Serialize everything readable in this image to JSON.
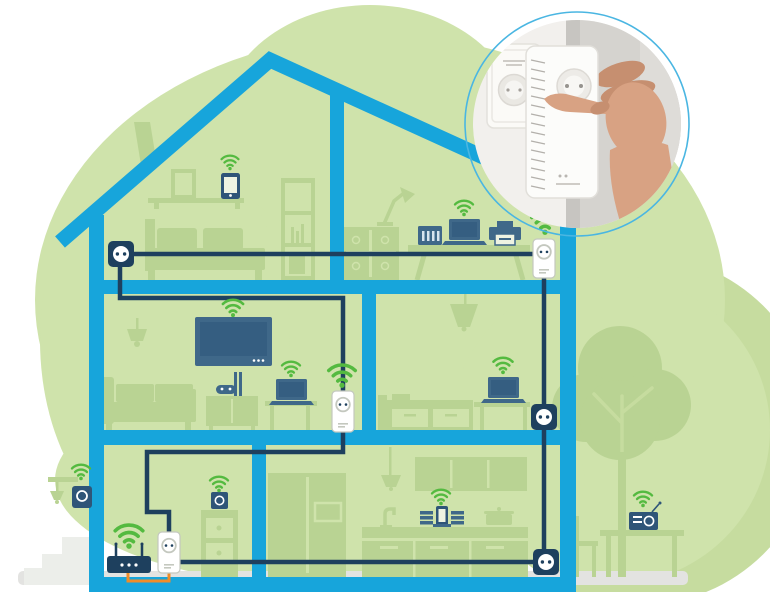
{
  "scene": {
    "description": "Cross-section illustration of a two-storey house with a powerline and WiFi home network; circular photo inset of a hand plugging a powerline adapter into a wall outlet",
    "inset_caption": "hand plugging white powerline adapter into wall socket",
    "colors": {
      "background": "#ffffff",
      "blob": "#cfe3ab",
      "blob2": "#c6dc9f",
      "silhouette": "#b9d393",
      "house": "#17a5db",
      "cable": "#1e405e",
      "device": "#3f6889",
      "device_dark": "#2f5578",
      "device_screen": "#355e81",
      "wifi": "#54ba40",
      "orange": "#f08c28",
      "ground": "#e3e3e1",
      "steps": "#eceeea",
      "ring": "#4ab6e2",
      "skin": "#d8a283",
      "skin_dark": "#c68f70",
      "photo_wall": "#f2f0ed",
      "photo_grey": "#d5d3cf",
      "photo_corner": "#c7c5c1",
      "adapter_line": "#c4c8bf"
    },
    "wifi_icons": [
      {
        "id": "wifi-attic-phone",
        "x": 230,
        "y": 155,
        "s": 0.8
      },
      {
        "id": "wifi-office-laptop",
        "x": 464,
        "y": 200,
        "s": 0.85
      },
      {
        "id": "wifi-office-adapter",
        "x": 545,
        "y": 211,
        "s": 1.25
      },
      {
        "id": "wifi-living-tv",
        "x": 233,
        "y": 299,
        "s": 0.95
      },
      {
        "id": "wifi-living-laptop",
        "x": 291,
        "y": 361,
        "s": 0.85
      },
      {
        "id": "wifi-living-adapter",
        "x": 342,
        "y": 364,
        "s": 1.25
      },
      {
        "id": "wifi-sitting-laptop",
        "x": 503,
        "y": 357,
        "s": 0.9
      },
      {
        "id": "wifi-router",
        "x": 129,
        "y": 524,
        "s": 1.3
      },
      {
        "id": "wifi-cellar-speaker",
        "x": 219,
        "y": 476,
        "s": 0.85
      },
      {
        "id": "wifi-kitchen-dock",
        "x": 441,
        "y": 489,
        "s": 0.85
      },
      {
        "id": "wifi-outdoor-speaker",
        "x": 81,
        "y": 464,
        "s": 0.85
      },
      {
        "id": "wifi-garden-radio",
        "x": 643,
        "y": 491,
        "s": 0.85
      }
    ],
    "outlets": [
      {
        "id": "outlet-attic",
        "x": 121,
        "y": 254
      },
      {
        "id": "outlet-sitting-room",
        "x": 544,
        "y": 417
      },
      {
        "id": "outlet-kitchen",
        "x": 546,
        "y": 562
      }
    ],
    "adapters": [
      {
        "id": "adapter-office",
        "x": 533,
        "y": 239,
        "w": 22,
        "h": 39
      },
      {
        "id": "adapter-living",
        "x": 332,
        "y": 391,
        "w": 22,
        "h": 41
      },
      {
        "id": "adapter-cellar",
        "x": 158,
        "y": 532,
        "w": 22,
        "h": 41
      }
    ],
    "laptops": [
      {
        "id": "laptop-office",
        "x": 449,
        "y": 219
      },
      {
        "id": "laptop-living",
        "x": 276,
        "y": 379
      },
      {
        "id": "laptop-sitting",
        "x": 488,
        "y": 377
      }
    ],
    "rooms": [
      {
        "name": "attic bedroom",
        "devices": [
          "smartphone"
        ]
      },
      {
        "name": "upper office",
        "devices": [
          "nas",
          "laptop",
          "printer",
          "powerline adapter"
        ]
      },
      {
        "name": "living room",
        "devices": [
          "tv",
          "game console",
          "laptop",
          "powerline adapter"
        ]
      },
      {
        "name": "sitting room",
        "devices": [
          "laptop",
          "wall outlet"
        ]
      },
      {
        "name": "cellar room",
        "devices": [
          "router",
          "powerline adapter",
          "speaker"
        ]
      },
      {
        "name": "kitchen",
        "devices": [
          "music dock",
          "wall outlet"
        ]
      },
      {
        "name": "garden",
        "devices": [
          "radio",
          "outdoor speaker"
        ]
      }
    ]
  }
}
